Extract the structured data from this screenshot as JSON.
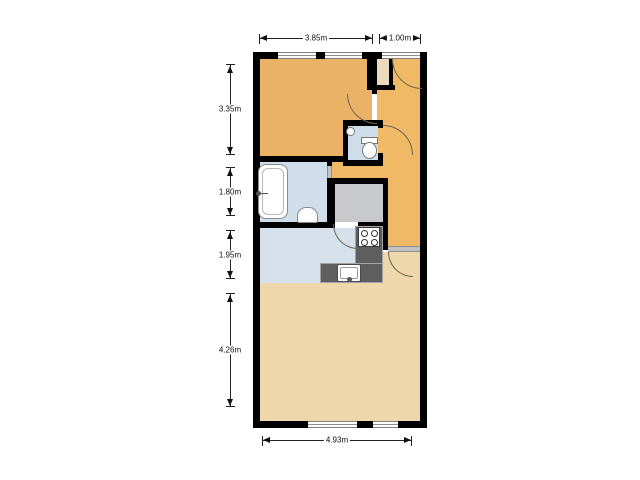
{
  "floorplan": {
    "rooms": {
      "slaapkamer": {
        "label": "Slaapkamer",
        "color": "#e9b267"
      },
      "hal": {
        "label": "Hal",
        "color": "#f0b966"
      },
      "toilet": {
        "label": "Toilet",
        "color": "#cddeea"
      },
      "badkamer": {
        "label": "Badkamer",
        "color": "#cfdeea"
      },
      "cv_berging": {
        "label": "CV / Berging",
        "color": "#c8c9ca"
      },
      "keuken": {
        "label": "Keuken",
        "color": "#d5e0ea"
      },
      "woonkamer": {
        "label": "Woonkamer",
        "color": "#eed8ab"
      },
      "entry_niche": {
        "label": "",
        "color": "#ebdabb"
      }
    },
    "dimensions": {
      "top_width_main": "3.85m",
      "top_width_entry": "1.00m",
      "left_slaapkamer": "3.35m",
      "left_badkamer": "1.80m",
      "left_keuken": "1.95m",
      "left_woonkamer": "4.26m",
      "bottom_width": "4.93m"
    },
    "colors": {
      "wall": "#000000",
      "door_arc": "#6f6550",
      "counter": "#5e5e5e",
      "threshold": "#c2c2c2"
    }
  }
}
